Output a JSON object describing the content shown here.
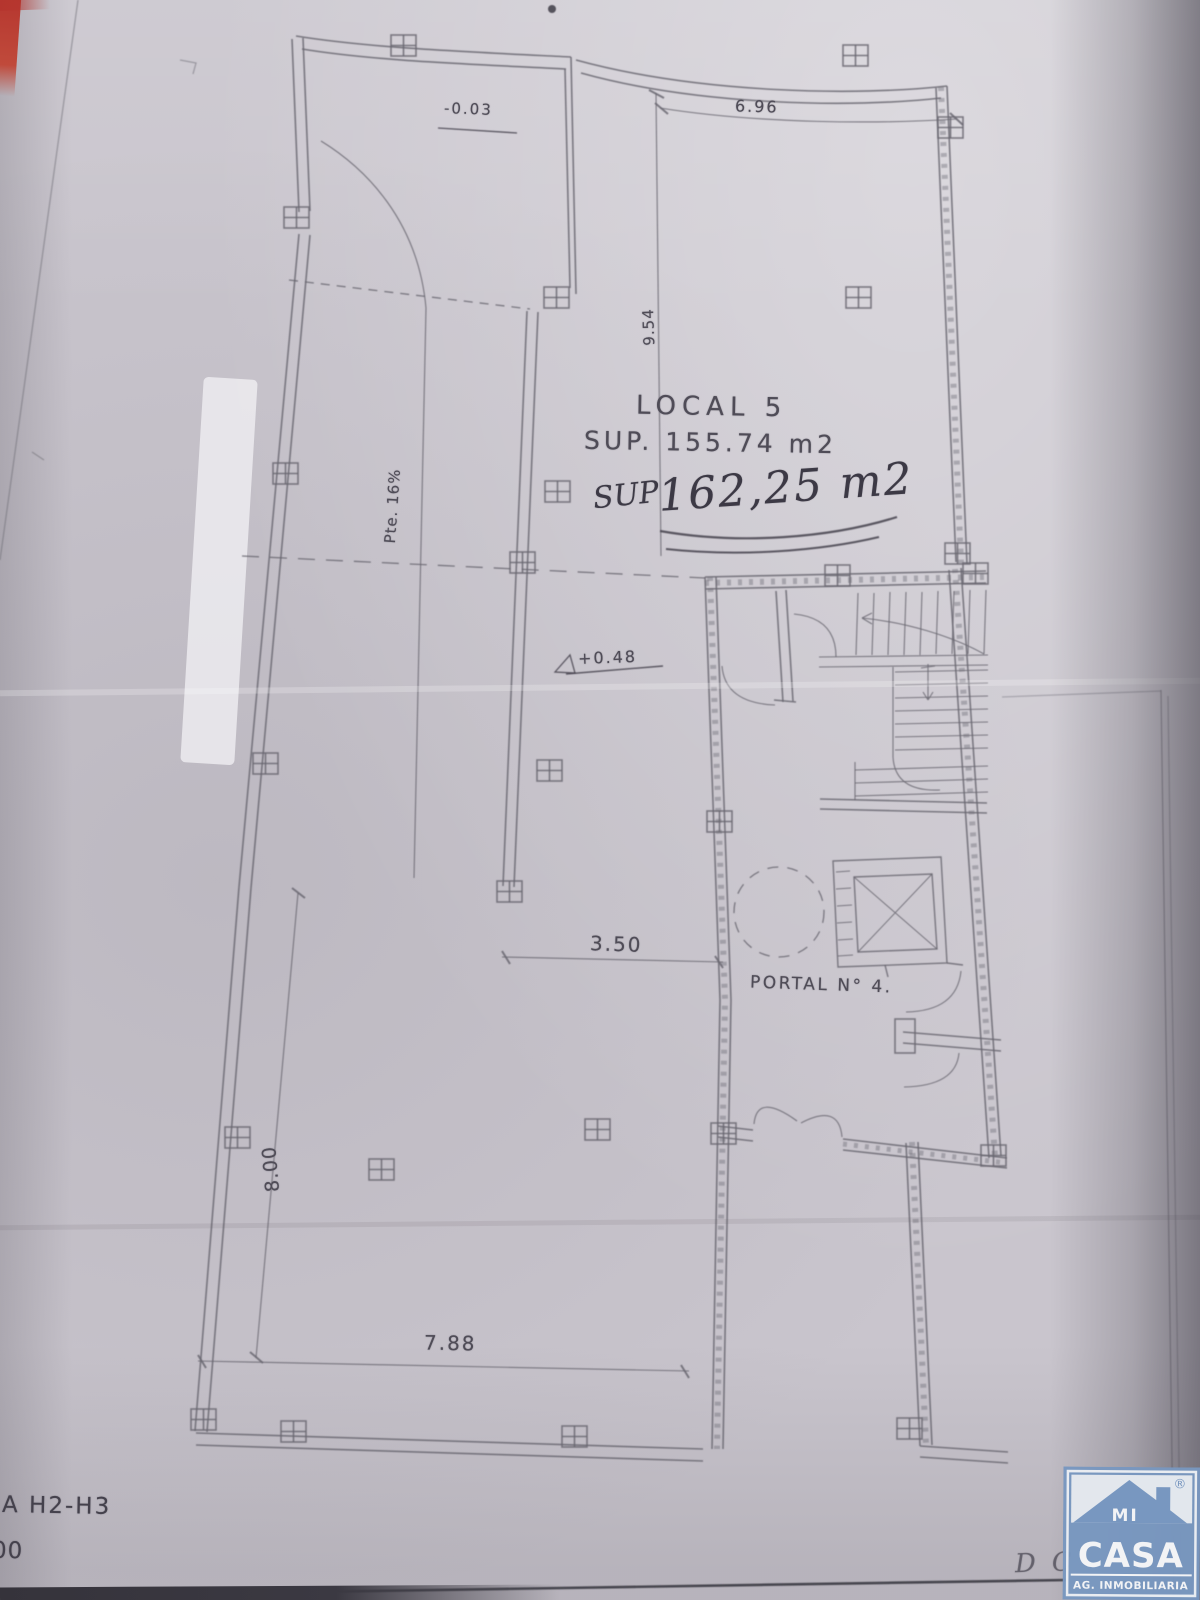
{
  "photo": {
    "description": "Scanned architectural floor plan on paper",
    "paper_color": "#c9c5cd",
    "line_color": "#6a6771",
    "ink_color": "#3c3945",
    "red_strip_color": "#b5352e"
  },
  "plan": {
    "room": {
      "title": "LOCAL 5",
      "area": "SUP. 155.74 m2"
    },
    "handwritten": {
      "prefix": "SUP",
      "area": "162,25 m2"
    },
    "levels": {
      "top": "-0.03",
      "mid": "+0.48"
    },
    "dims": {
      "top": "6.96",
      "right": "9.54",
      "mid": "3.50",
      "left": "8.00",
      "bottom": "7.88"
    },
    "ramp_label": "Pte. 16%",
    "portal_label": "PORTAL N° 4.",
    "title_block": {
      "line1": "A H2-H3",
      "line2": "00"
    },
    "faint_note": "DC"
  },
  "logo": {
    "word1": "MI",
    "word2": "CASA",
    "tagline": "AG. INMOBILIARIA",
    "registered": "®",
    "blue": "#7897c0"
  }
}
